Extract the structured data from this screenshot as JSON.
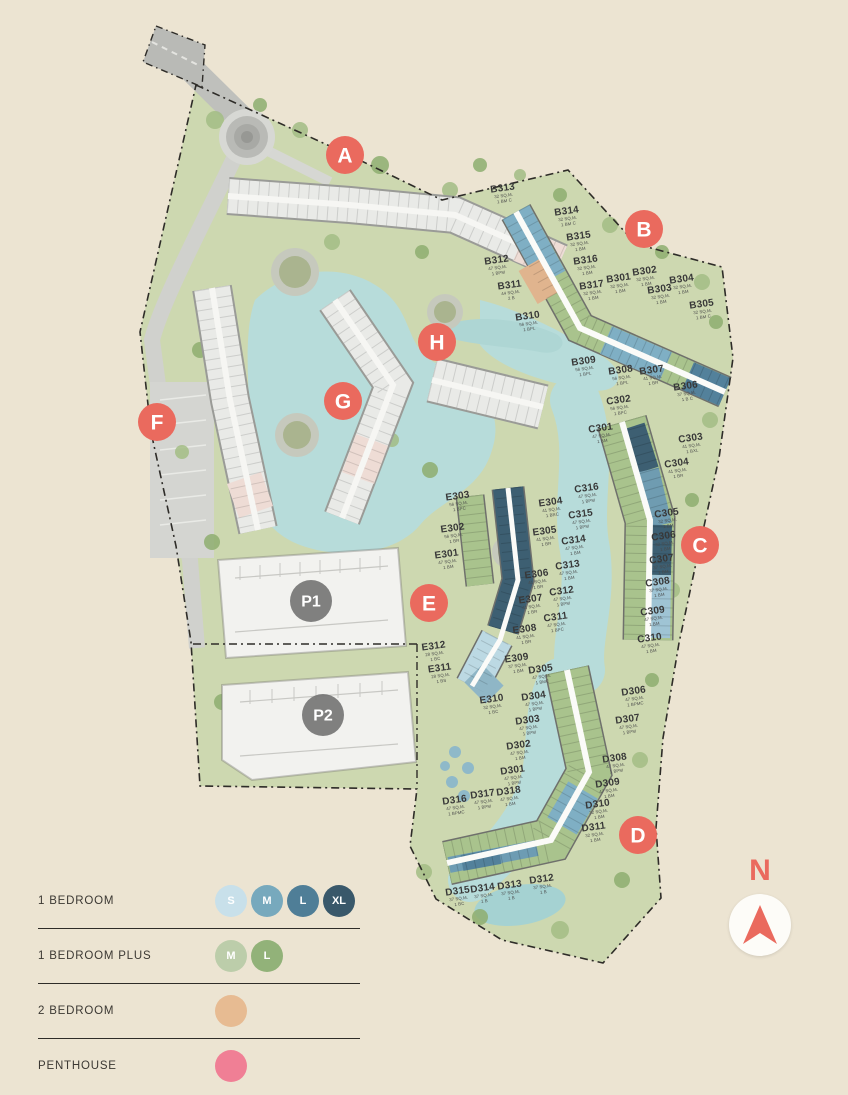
{
  "site": {
    "markers": [
      {
        "id": "A",
        "x": 345,
        "y": 155,
        "kind": "building"
      },
      {
        "id": "B",
        "x": 644,
        "y": 229,
        "kind": "building"
      },
      {
        "id": "C",
        "x": 700,
        "y": 545,
        "kind": "building"
      },
      {
        "id": "D",
        "x": 638,
        "y": 835,
        "kind": "building"
      },
      {
        "id": "E",
        "x": 429,
        "y": 603,
        "kind": "building"
      },
      {
        "id": "F",
        "x": 157,
        "y": 422,
        "kind": "building"
      },
      {
        "id": "G",
        "x": 343,
        "y": 401,
        "kind": "building"
      },
      {
        "id": "H",
        "x": 437,
        "y": 342,
        "kind": "building"
      },
      {
        "id": "P1",
        "x": 311,
        "y": 601,
        "kind": "parking"
      },
      {
        "id": "P2",
        "x": 323,
        "y": 715,
        "kind": "parking"
      }
    ],
    "units": [
      {
        "id": "B313",
        "x": 503,
        "y": 191,
        "area": "32 SQ.M.",
        "type": "1 BM C"
      },
      {
        "id": "B314",
        "x": 567,
        "y": 214,
        "area": "32 SQ.M.",
        "type": "1 BM C"
      },
      {
        "id": "B315",
        "x": 579,
        "y": 239,
        "area": "32 SQ.M.",
        "type": "1 BM"
      },
      {
        "id": "B316",
        "x": 586,
        "y": 263,
        "area": "32 SQ.M.",
        "type": "1 BM"
      },
      {
        "id": "B317",
        "x": 592,
        "y": 288,
        "area": "32 SQ.M.",
        "type": "1 BM"
      },
      {
        "id": "B312",
        "x": 497,
        "y": 263,
        "area": "47 SQ.M.",
        "type": "1 BPM"
      },
      {
        "id": "B311",
        "x": 510,
        "y": 288,
        "area": "44 SQ.M.",
        "type": "2 B"
      },
      {
        "id": "B310",
        "x": 528,
        "y": 319,
        "area": "56 SQ.M.",
        "type": "1 BPL"
      },
      {
        "id": "B301",
        "x": 619,
        "y": 281,
        "area": "32 SQ.M.",
        "type": "1 BM"
      },
      {
        "id": "B302",
        "x": 645,
        "y": 274,
        "area": "32 SQ.M.",
        "type": "1 BM"
      },
      {
        "id": "B303",
        "x": 660,
        "y": 292,
        "area": "32 SQ.M.",
        "type": "1 BM"
      },
      {
        "id": "B304",
        "x": 682,
        "y": 282,
        "area": "32 SQ.M.",
        "type": "1 BM"
      },
      {
        "id": "B305",
        "x": 702,
        "y": 307,
        "area": "32 SQ.M.",
        "type": "1 BM C"
      },
      {
        "id": "B306",
        "x": 686,
        "y": 389,
        "area": "37 SQ.M.",
        "type": "1 B C"
      },
      {
        "id": "B307",
        "x": 652,
        "y": 373,
        "area": "41 SQ.M.",
        "type": "1 BR"
      },
      {
        "id": "B308",
        "x": 621,
        "y": 373,
        "area": "56 SQ.M.",
        "type": "1 BPL"
      },
      {
        "id": "B309",
        "x": 584,
        "y": 364,
        "area": "56 SQ.M.",
        "type": "1 BPL"
      },
      {
        "id": "C301",
        "x": 601,
        "y": 431,
        "area": "47 SQ.M.",
        "type": "1 BM"
      },
      {
        "id": "C302",
        "x": 619,
        "y": 403,
        "area": "56 SQ.M.",
        "type": "1 BPC"
      },
      {
        "id": "C303",
        "x": 691,
        "y": 441,
        "area": "41 SQ.M.",
        "type": "1 BXL"
      },
      {
        "id": "C304",
        "x": 677,
        "y": 466,
        "area": "41 SQ.M.",
        "type": "1 BR"
      },
      {
        "id": "C305",
        "x": 667,
        "y": 516,
        "area": "32 SQ.M.",
        "type": "1 BM"
      },
      {
        "id": "C306",
        "x": 664,
        "y": 539,
        "area": "32 SQ.M.",
        "type": "1 BM"
      },
      {
        "id": "C307",
        "x": 662,
        "y": 562,
        "area": "37 SQ.M.",
        "type": "1 BM"
      },
      {
        "id": "C308",
        "x": 658,
        "y": 585,
        "area": "37 SQ.M.",
        "type": "1 BM"
      },
      {
        "id": "C309",
        "x": 653,
        "y": 614,
        "area": "47 SQ.M.",
        "type": "1 BM"
      },
      {
        "id": "C310",
        "x": 650,
        "y": 641,
        "area": "47 SQ.M.",
        "type": "1 BM"
      },
      {
        "id": "C311",
        "x": 556,
        "y": 620,
        "area": "47 SQ.M.",
        "type": "1 BPC"
      },
      {
        "id": "C312",
        "x": 562,
        "y": 594,
        "area": "47 SQ.M.",
        "type": "1 BPM"
      },
      {
        "id": "C313",
        "x": 568,
        "y": 568,
        "area": "47 SQ.M.",
        "type": "1 BM"
      },
      {
        "id": "C314",
        "x": 574,
        "y": 543,
        "area": "47 SQ.M.",
        "type": "1 BM"
      },
      {
        "id": "C315",
        "x": 581,
        "y": 517,
        "area": "47 SQ.M.",
        "type": "1 BPM"
      },
      {
        "id": "C316",
        "x": 587,
        "y": 491,
        "area": "47 SQ.M.",
        "type": "1 BPM"
      },
      {
        "id": "E301",
        "x": 447,
        "y": 557,
        "area": "47 SQ.M.",
        "type": "1 BM"
      },
      {
        "id": "E302",
        "x": 453,
        "y": 531,
        "area": "56 SQ.M.",
        "type": "1 BR"
      },
      {
        "id": "E303",
        "x": 458,
        "y": 499,
        "area": "56 SQ.M.",
        "type": "1 BPC"
      },
      {
        "id": "E304",
        "x": 551,
        "y": 505,
        "area": "41 SQ.M.",
        "type": "1 BRC"
      },
      {
        "id": "E305",
        "x": 545,
        "y": 534,
        "area": "41 SQ.M.",
        "type": "1 BR"
      },
      {
        "id": "E306",
        "x": 537,
        "y": 577,
        "area": "41 SQ.M.",
        "type": "1 BR"
      },
      {
        "id": "E307",
        "x": 531,
        "y": 602,
        "area": "41 SQ.M.",
        "type": "1 BR"
      },
      {
        "id": "E308",
        "x": 525,
        "y": 632,
        "area": "41 SQ.M.",
        "type": "1 BR"
      },
      {
        "id": "E309",
        "x": 517,
        "y": 661,
        "area": "37 SQ.M.",
        "type": "1 BM"
      },
      {
        "id": "E310",
        "x": 492,
        "y": 702,
        "area": "32 SQ.M.",
        "type": "1 BC"
      },
      {
        "id": "E311",
        "x": 440,
        "y": 671,
        "area": "28 SQ.M.",
        "type": "1 BS"
      },
      {
        "id": "E312",
        "x": 434,
        "y": 649,
        "area": "28 SQ.M.",
        "type": "1 BC"
      },
      {
        "id": "D301",
        "x": 513,
        "y": 773,
        "area": "47 SQ.M.",
        "type": "1 BPM"
      },
      {
        "id": "D302",
        "x": 519,
        "y": 748,
        "area": "47 SQ.M.",
        "type": "1 BM"
      },
      {
        "id": "D303",
        "x": 528,
        "y": 723,
        "area": "47 SQ.M.",
        "type": "1 BPM"
      },
      {
        "id": "D304",
        "x": 534,
        "y": 699,
        "area": "47 SQ.M.",
        "type": "1 BPM"
      },
      {
        "id": "D305",
        "x": 541,
        "y": 672,
        "area": "47 SQ.M.",
        "type": "1 BMC"
      },
      {
        "id": "D306",
        "x": 634,
        "y": 694,
        "area": "47 SQ.M.",
        "type": "1 BPMC"
      },
      {
        "id": "D307",
        "x": 628,
        "y": 722,
        "area": "47 SQ.M.",
        "type": "1 BPM"
      },
      {
        "id": "D308",
        "x": 615,
        "y": 761,
        "area": "47 SQ.M.",
        "type": "1 BPM"
      },
      {
        "id": "D309",
        "x": 608,
        "y": 786,
        "area": "47 SQ.M.",
        "type": "1 BM"
      },
      {
        "id": "D310",
        "x": 598,
        "y": 807,
        "area": "32 SQ.M.",
        "type": "1 BM"
      },
      {
        "id": "D311",
        "x": 594,
        "y": 830,
        "area": "32 SQ.M.",
        "type": "1 BM"
      },
      {
        "id": "D312",
        "x": 542,
        "y": 882,
        "area": "37 SQ.M.",
        "type": "1 B"
      },
      {
        "id": "D313",
        "x": 510,
        "y": 888,
        "area": "37 SQ.M.",
        "type": "1 B"
      },
      {
        "id": "D314",
        "x": 483,
        "y": 891,
        "area": "37 SQ.M.",
        "type": "1 B"
      },
      {
        "id": "D315",
        "x": 458,
        "y": 894,
        "area": "37 SQ.M.",
        "type": "1 BC"
      },
      {
        "id": "D316",
        "x": 455,
        "y": 803,
        "area": "47 SQ.M.",
        "type": "1 BPMC"
      },
      {
        "id": "D317",
        "x": 483,
        "y": 797,
        "area": "47 SQ.M.",
        "type": "1 BPM"
      },
      {
        "id": "D318",
        "x": 509,
        "y": 794,
        "area": "47 SQ.M.",
        "type": "1 BM"
      }
    ]
  },
  "legend": {
    "rows": [
      {
        "label": "1 BEDROOM",
        "swatches": [
          {
            "letter": "S",
            "color": "#c8e0ea"
          },
          {
            "letter": "M",
            "color": "#77a9bd"
          },
          {
            "letter": "L",
            "color": "#4f7e97"
          },
          {
            "letter": "XL",
            "color": "#39586a"
          }
        ]
      },
      {
        "label": "1 BEDROOM PLUS",
        "swatches": [
          {
            "letter": "M",
            "color": "#bccdaa"
          },
          {
            "letter": "L",
            "color": "#92b279"
          }
        ]
      },
      {
        "label": "2 BEDROOM",
        "swatches": [
          {
            "letter": "",
            "color": "#e7bb92"
          }
        ]
      },
      {
        "label": "PENTHOUSE",
        "swatches": [
          {
            "letter": "",
            "color": "#f07f95"
          }
        ]
      }
    ]
  },
  "compass": {
    "label": "N"
  },
  "colors": {
    "building_marker": "#ea6a5e",
    "parking_marker": "#6f6f6f",
    "site_green": "#cdd8b0",
    "water": "#b7dcda",
    "background": "#ece4d2"
  }
}
